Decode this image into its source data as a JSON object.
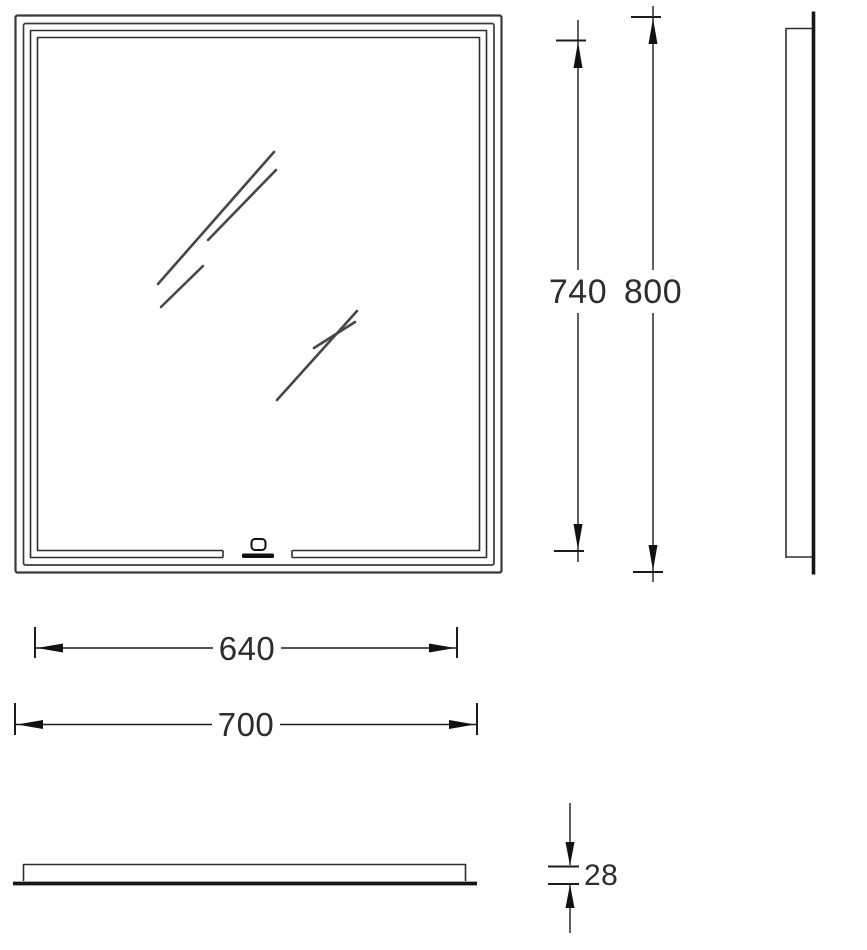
{
  "drawing": {
    "kind": "mirror-dimensional-drawing",
    "colors": {
      "background": "#ffffff",
      "frame_line": "#3a3a3a",
      "slot_line": "#2e2e2e",
      "thick_edge": "#161616",
      "dim_line": "#1c1c1c",
      "text": "#2d2d2d"
    },
    "dimensions": {
      "inner_height": "740",
      "overall_height": "800",
      "inner_width": "640",
      "overall_width": "700",
      "depth": "28"
    }
  }
}
